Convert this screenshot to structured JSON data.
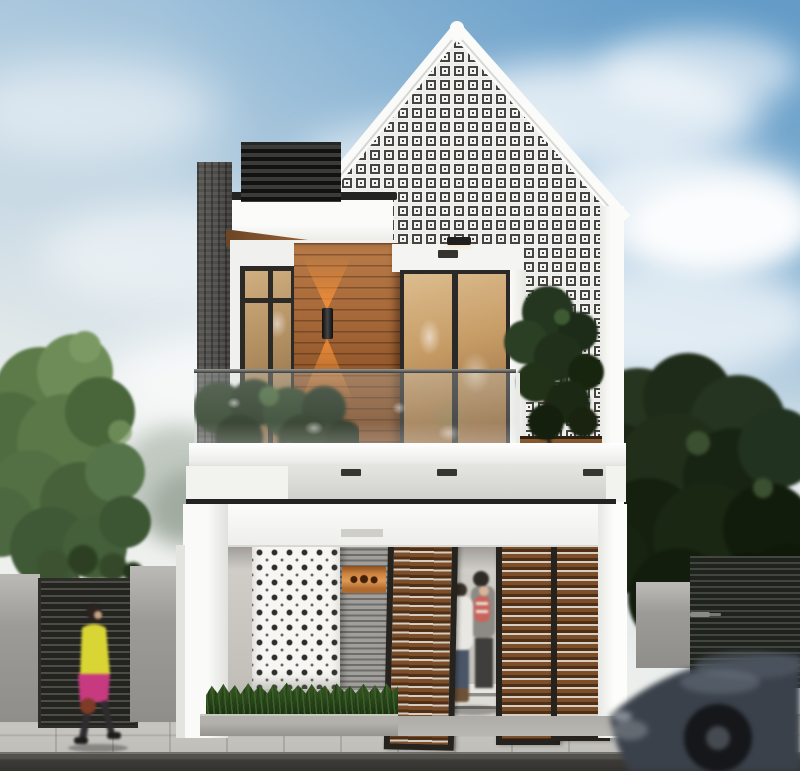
{
  "meta": {
    "title": "Architectural render of a modern minimalist two-storey house with gabled breeze-block facade, wood accents, glass balcony, pedestrians and a passing car",
    "canvas": {
      "width": 800,
      "height": 771
    }
  },
  "palette": {
    "sky_top": "#6fa2c9",
    "sky_mid": "#c3d6e3",
    "sky_horizon": "#eef0ed",
    "cloud": "#ffffff",
    "wall_white": "#f5f5f2",
    "frame_dark": "#2b2825",
    "brick_gray": "#4c4a47",
    "wood_light": "#b97b48",
    "wood_dark": "#6e3f1e",
    "wood_door": "#7c4e2a",
    "wood_gap": "#d6cec2",
    "glass_warm": "#c89e68",
    "glass_deep": "#8a6038",
    "glow_orange": "#ff9a3c",
    "breeze_bg": "#f3f3f1",
    "breeze_hole": "#45443f",
    "gray_wall": "#9c9b97",
    "plaque_orange": "#cf8440",
    "grass_green": "#2c4a1e",
    "tree_green": "#5c7b49",
    "tree_dark": "#1e2b18",
    "sidewalk": "#c6c5c0",
    "road": "#3c3b38",
    "car_body": "#3a414b",
    "shirt_yellow": "#d8d534",
    "skirt_pink": "#c73a80",
    "jeans_blue": "#4a5668",
    "jacket_white": "#e9e7e2",
    "child_red": "#c9645a"
  },
  "scene": {
    "objects": [
      "sky-with-clouds",
      "gable-roof-breeze-block-facade",
      "flat-roof-side-volume-with-dark-slats",
      "wood-feature-wall-with-sconce",
      "glass-balcony-railing-with-plants",
      "sliding-glass-door",
      "ground-floor-portal-frame",
      "perforated-dot-screen-panel",
      "house-number-plaque",
      "wood-slat-pivot-doors",
      "family-at-entrance",
      "grass-planter",
      "left-boundary-wall-and-gate",
      "walking-pedestrian",
      "right-fence-and-hedge",
      "passing-car-motion-blur",
      "sidewalk-and-road"
    ]
  }
}
